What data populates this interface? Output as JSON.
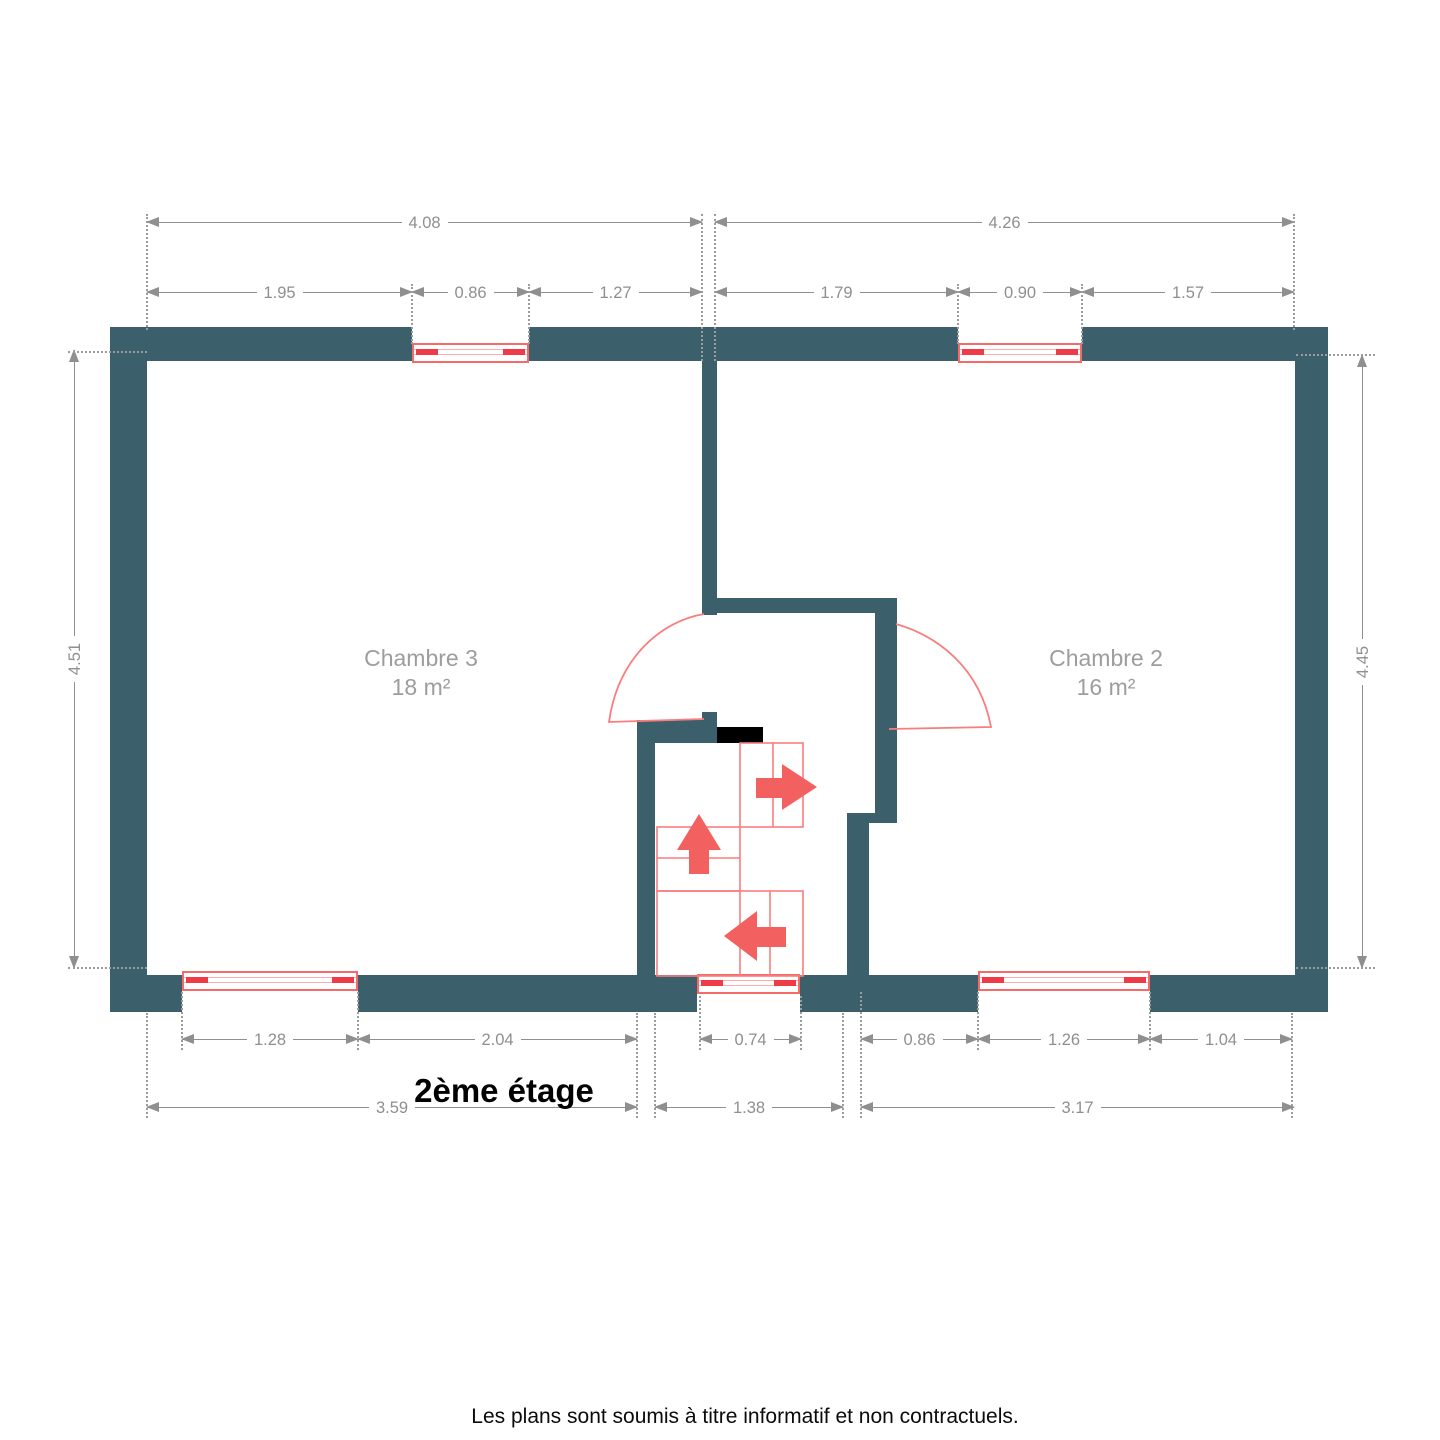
{
  "title": "2ème étage",
  "footer": "Les plans sont soumis à titre informatif et non contractuels.",
  "rooms": [
    {
      "name": "Chambre 3",
      "area": "18 m²"
    },
    {
      "name": "Chambre 2",
      "area": "16 m²"
    }
  ],
  "dims": {
    "top_overall": [
      "4.08",
      "4.26"
    ],
    "top_segs": [
      "1.95",
      "0.86",
      "1.27",
      "1.79",
      "0.90",
      "1.57"
    ],
    "sides": {
      "left": "4.51",
      "right": "4.45"
    },
    "bottom_segs": [
      "1.28",
      "2.04",
      "0.74",
      "0.86",
      "1.26",
      "1.04"
    ],
    "bottom_overall": [
      "3.59",
      "1.38",
      "3.17"
    ]
  },
  "colors": {
    "wall": "#3b5f6b",
    "stair_outline": "#fa7d7d",
    "window_frame": "#f66a6a",
    "window_line": "#fbadad",
    "window_accent": "#ef3b47",
    "arrow": "#f2615f",
    "dimension": "#8f8f8f",
    "room_label": "#9d9d9d",
    "threshold": "#000000"
  }
}
